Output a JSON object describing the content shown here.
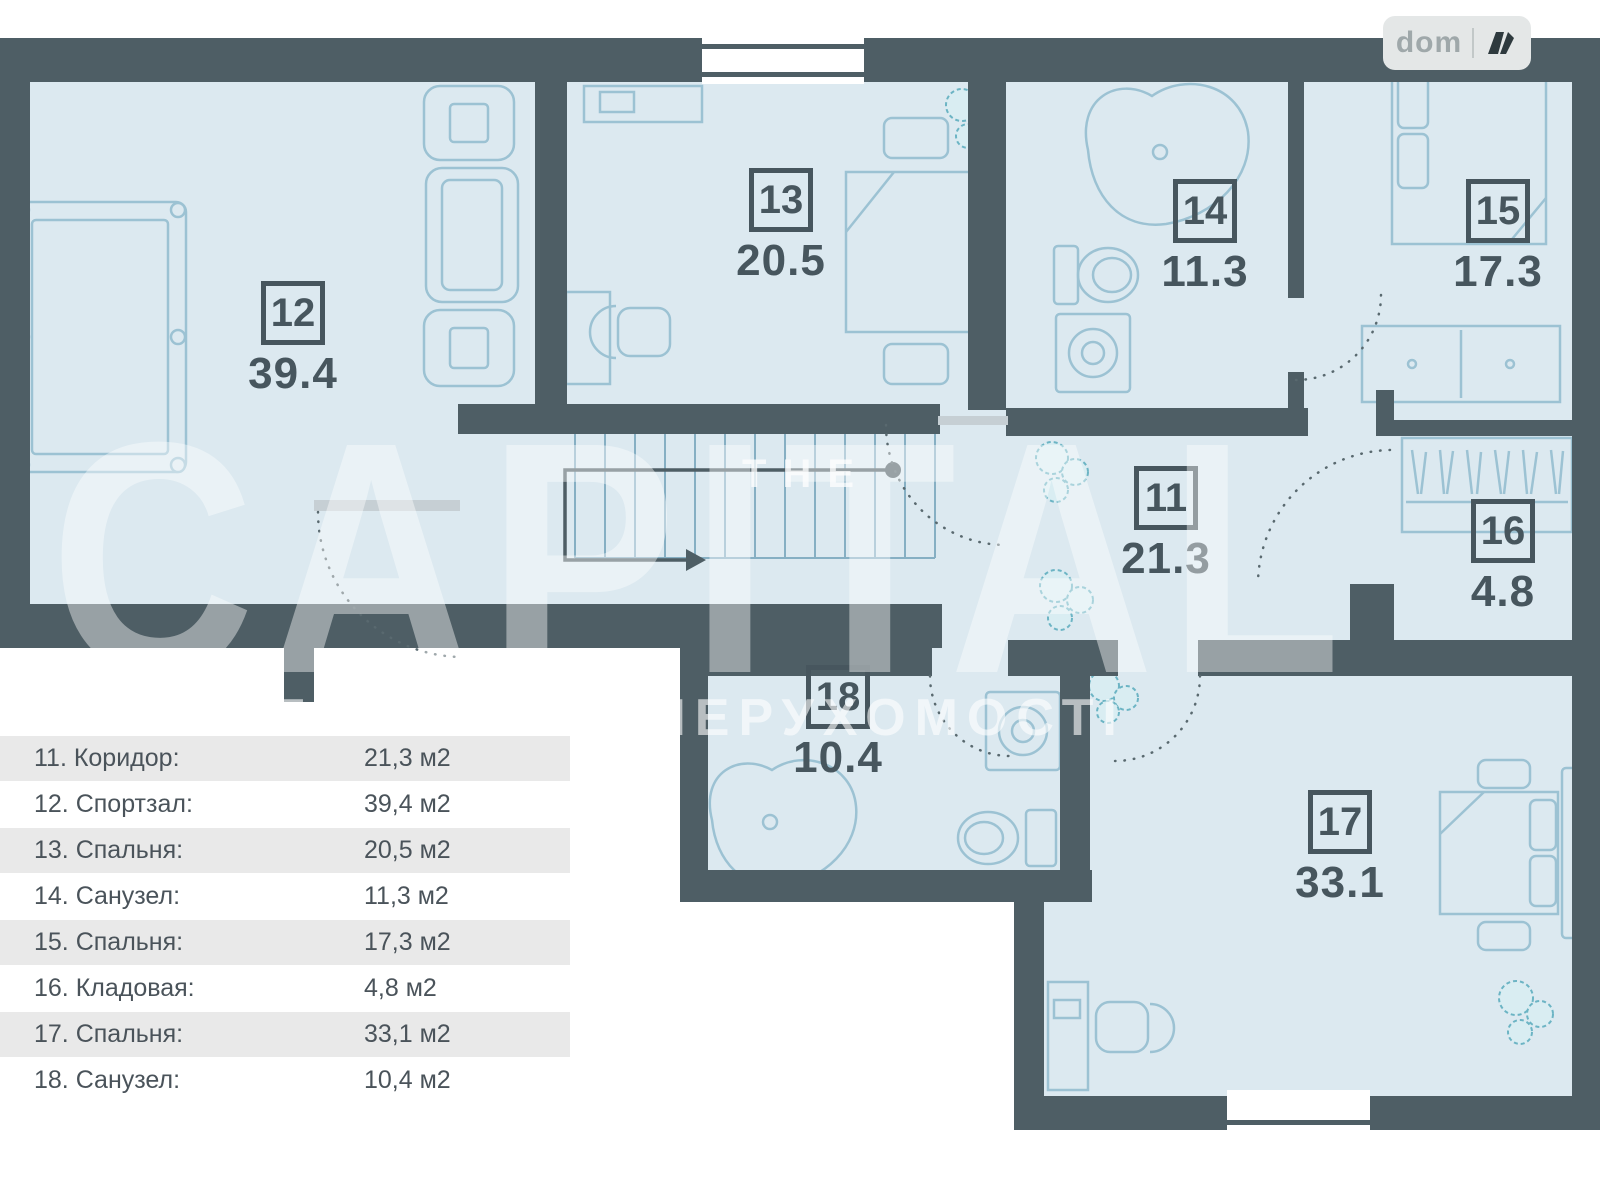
{
  "plan": {
    "rooms": [
      {
        "number": "11",
        "area": "21.3"
      },
      {
        "number": "12",
        "area": "39.4"
      },
      {
        "number": "13",
        "area": "20.5"
      },
      {
        "number": "14",
        "area": "11.3"
      },
      {
        "number": "15",
        "area": "17.3"
      },
      {
        "number": "16",
        "area": "4.8"
      },
      {
        "number": "17",
        "area": "33.1"
      },
      {
        "number": "18",
        "area": "10.4"
      }
    ]
  },
  "legend": {
    "rows": [
      {
        "label": "11. Коридор:",
        "value": "21,3 м2"
      },
      {
        "label": "12. Спортзал:",
        "value": "39,4 м2"
      },
      {
        "label": "13. Спальня:",
        "value": "20,5 м2"
      },
      {
        "label": "14. Санузел:",
        "value": "11,3 м2"
      },
      {
        "label": "15. Спальня:",
        "value": "17,3 м2"
      },
      {
        "label": "16. Кладовая:",
        "value": "4,8 м2"
      },
      {
        "label": "17. Спальня:",
        "value": "33,1 м2"
      },
      {
        "label": "18. Санузел:",
        "value": "10,4 м2"
      }
    ]
  },
  "watermark": {
    "the": "THE",
    "capital": "CAPITAL",
    "subtitle": "АГЕНТСТВО НЕРУХОМОСТІ"
  },
  "logo": {
    "text": "dom"
  },
  "colors": {
    "wall": "#4e5e65",
    "room_fill": "#dce9f0",
    "furniture_outline": "#9cc2d3",
    "plant": "#6cb4c4",
    "legend_row_bg": "#e9e9e9",
    "label_text": "#47565e"
  }
}
